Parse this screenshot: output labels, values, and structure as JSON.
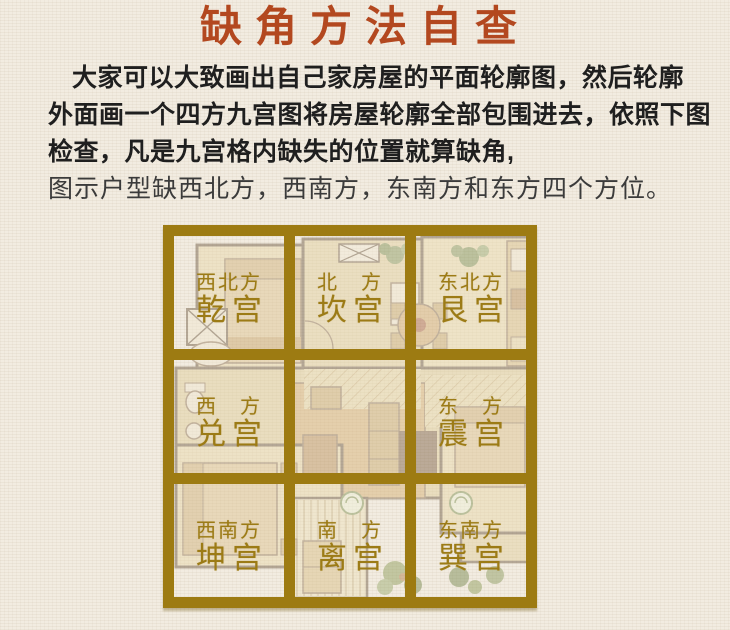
{
  "title": {
    "text": "缺角方法自查",
    "color": "#b3481f"
  },
  "intro": {
    "lines": [
      "大家可以大致画出自己家房屋的平面轮廓图，然后轮廓",
      "外面画一个四方九宫图将房屋轮廓全部包围进去，依照下图",
      "检查，凡是九宫格内缺失的位置就算缺角,",
      "图示户型缺西北方，西南方，东南方和东方四个方位。"
    ]
  },
  "nine_palace_grid": {
    "border_color": "#9d7b12",
    "label_color": "#9c7b16",
    "cells": [
      {
        "position": "northwest",
        "direction": "西北方",
        "palace": "乾宫"
      },
      {
        "position": "north",
        "direction": "北　方",
        "palace": "坎宫"
      },
      {
        "position": "northeast",
        "direction": "东北方",
        "palace": "艮宫"
      },
      {
        "position": "west",
        "direction": "西　方",
        "palace": "兑宫"
      },
      {
        "position": "center",
        "direction": "",
        "palace": ""
      },
      {
        "position": "east",
        "direction": "东　方",
        "palace": "震宫"
      },
      {
        "position": "southwest",
        "direction": "西南方",
        "palace": "坤宫"
      },
      {
        "position": "south",
        "direction": "南　方",
        "palace": "离宫"
      },
      {
        "position": "southeast",
        "direction": "东南方",
        "palace": "巽宫"
      }
    ]
  },
  "icons": {
    "floor_plan": "floor-plan-illustration"
  }
}
